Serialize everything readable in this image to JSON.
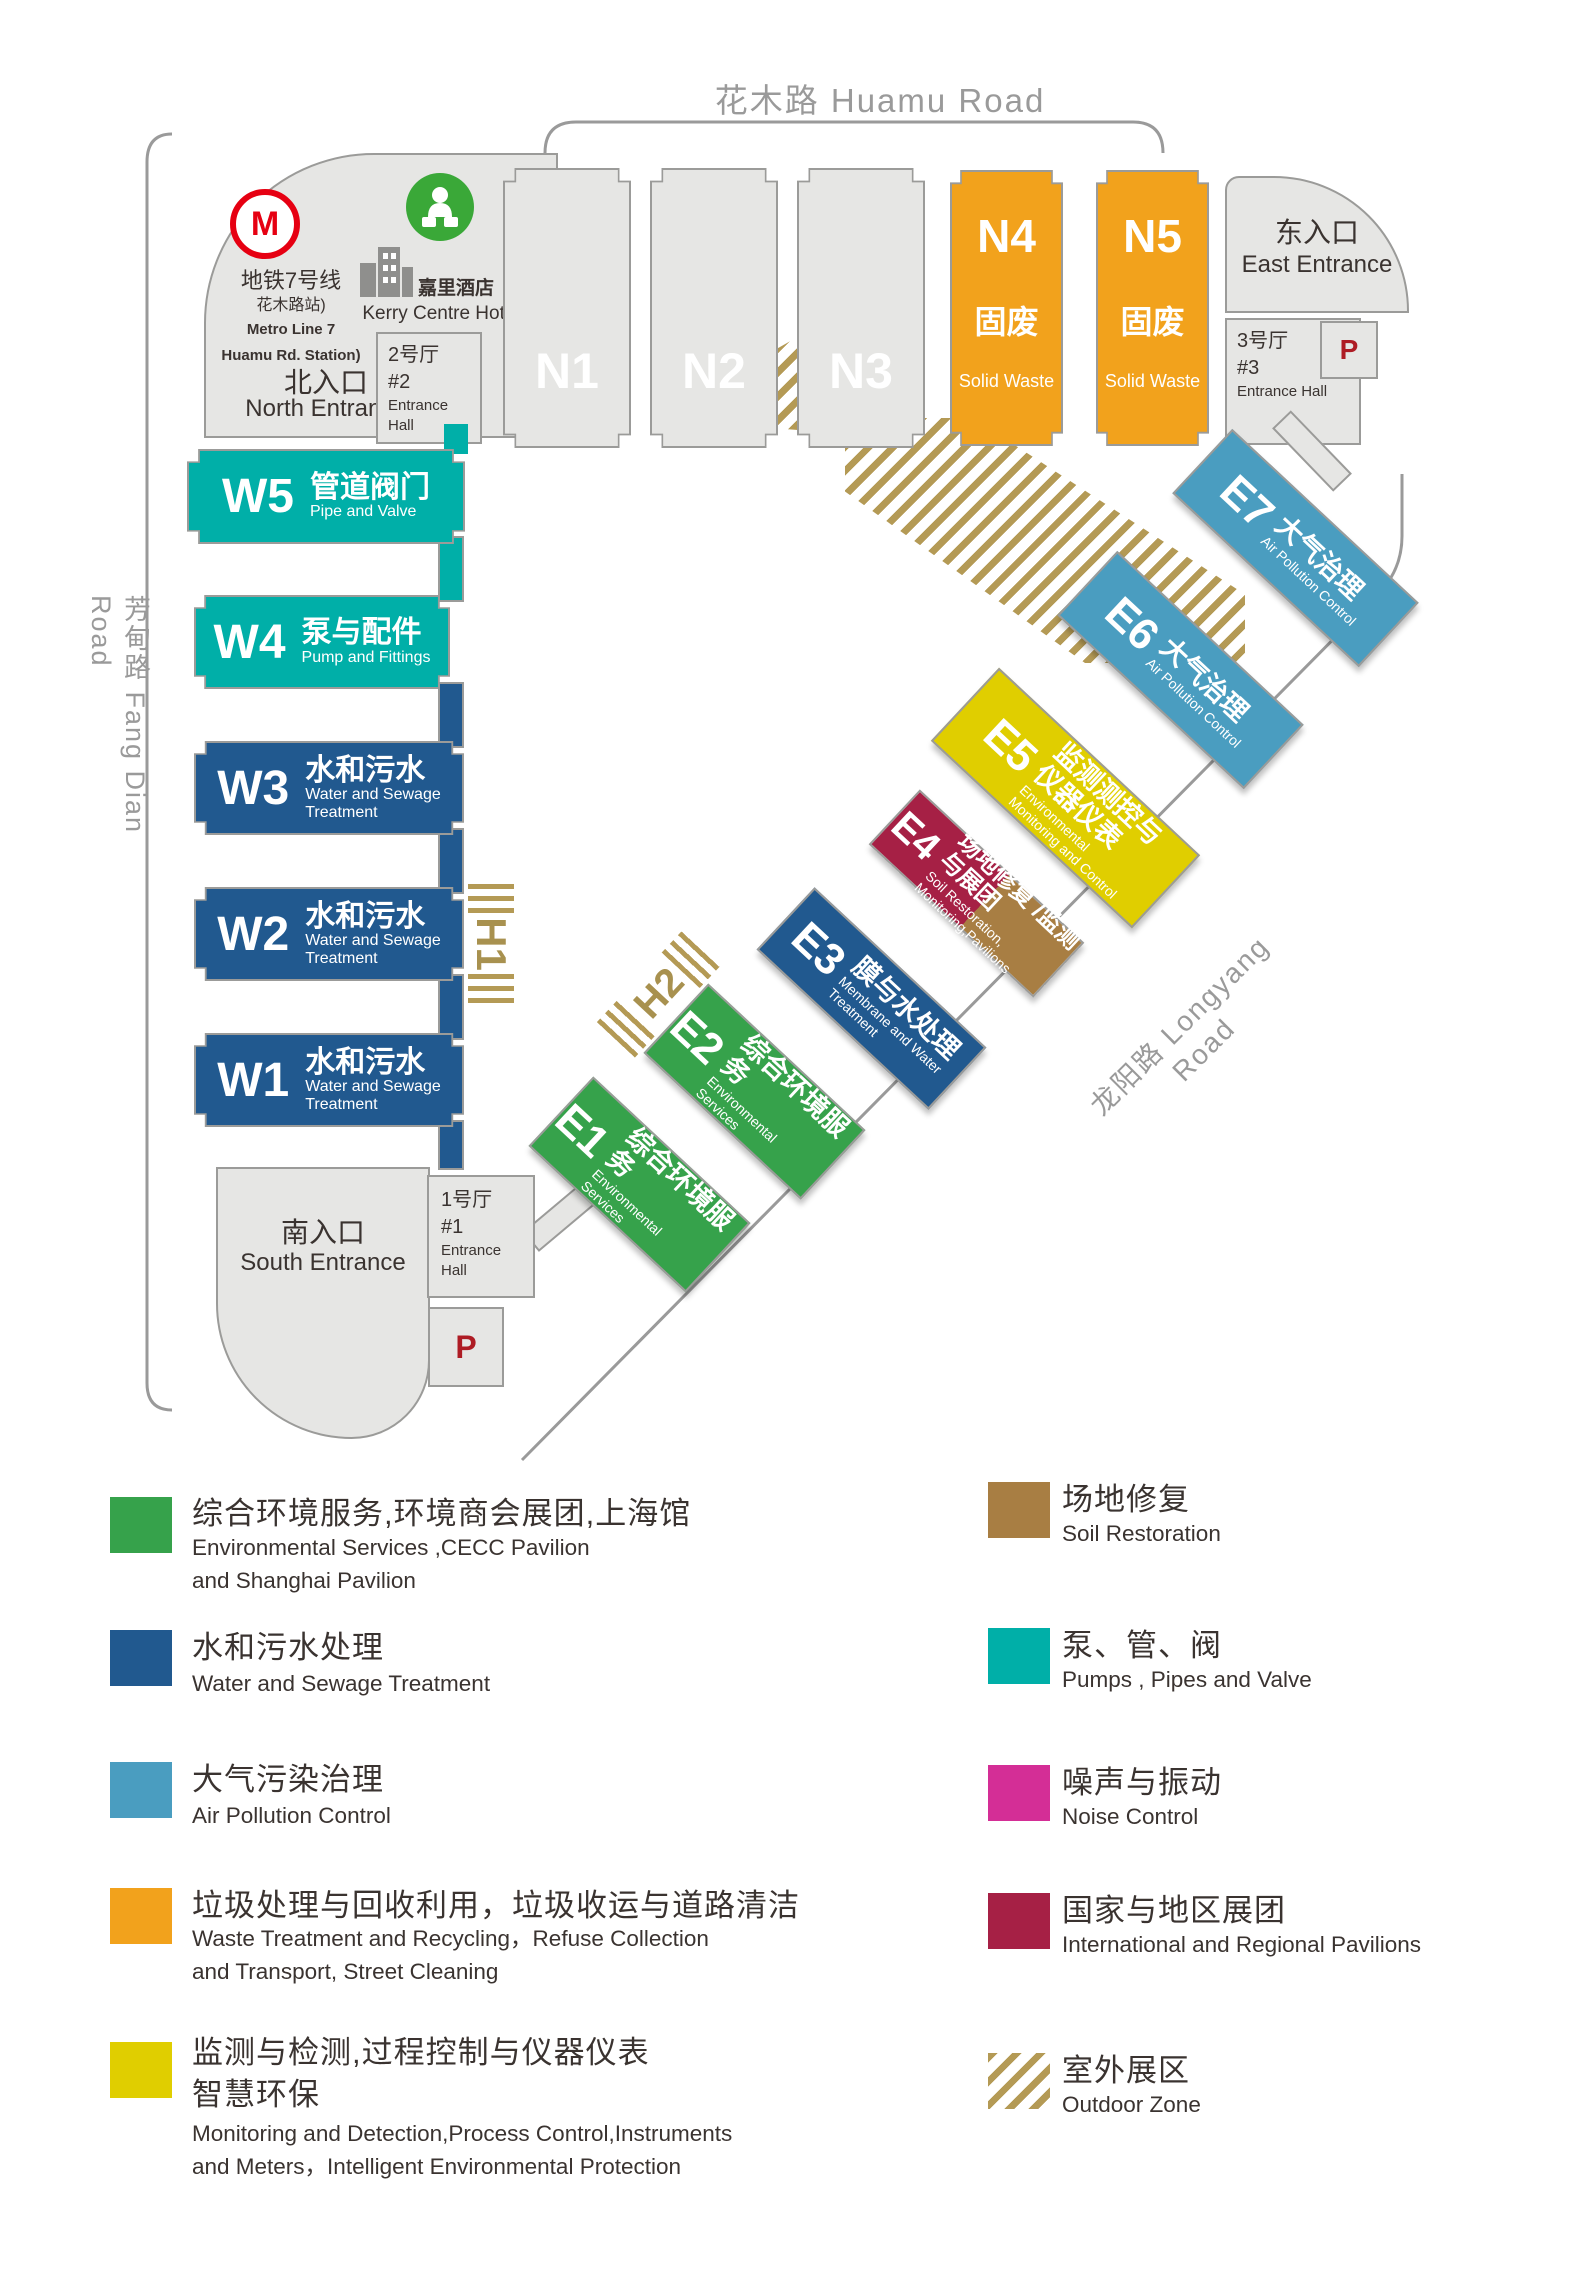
{
  "roads": {
    "huamu": "花木路 Huamu Road",
    "fangdian": "芳甸路  Fang Dian Road",
    "longyang": "龙阳路  Longyang Road"
  },
  "landmarks": {
    "metro_logo_letter": "M",
    "metro_line_zh": "地铁7号线",
    "metro_station_zh": "花木路站)",
    "metro_line_en": "Metro Line 7",
    "metro_station_en": "Huamu Rd. Station)",
    "hotel_zh": "嘉里酒店",
    "hotel_en": "Kerry Centre Hotel"
  },
  "entrances": {
    "north_zh": "北入口",
    "north_en": "North Entrance",
    "south_zh": "南入口",
    "south_en": "South Entrance",
    "east_zh": "东入口",
    "east_en": "East Entrance"
  },
  "entrance_halls": {
    "label_en": "Entrance Hall",
    "h1_zh": "1号厅",
    "h1_num": "#1",
    "h2_zh": "2号厅",
    "h2_num": "#2",
    "h3_zh": "3号厅",
    "h3_num": "#3"
  },
  "parking_label": "P",
  "outdoor_labels": {
    "h1": "H1",
    "h2": "H2",
    "h3": "H3"
  },
  "halls": {
    "n1": {
      "code": "N1"
    },
    "n2": {
      "code": "N2"
    },
    "n3": {
      "code": "N3"
    },
    "n4": {
      "code": "N4",
      "zh": "固废",
      "en": "Solid Waste"
    },
    "n5": {
      "code": "N5",
      "zh": "固废",
      "en": "Solid Waste"
    },
    "w5": {
      "code": "W5",
      "zh": "管道阀门",
      "en": "Pipe and Valve"
    },
    "w4": {
      "code": "W4",
      "zh": "泵与配件",
      "en": "Pump and Fittings"
    },
    "w3": {
      "code": "W3",
      "zh": "水和污水",
      "en": "Water and Sewage\nTreatment"
    },
    "w2": {
      "code": "W2",
      "zh": "水和污水",
      "en": "Water and Sewage\nTreatment"
    },
    "w1": {
      "code": "W1",
      "zh": "水和污水",
      "en": "Water and Sewage\nTreatment"
    },
    "e1": {
      "code": "E1",
      "zh": "综合环境服务",
      "en": "Environmental\nServices"
    },
    "e2": {
      "code": "E2",
      "zh": "综合环境服务",
      "en": "Environmental\nServices"
    },
    "e3": {
      "code": "E3",
      "zh": "膜与水处理",
      "en": "Membrane and Water\nTreatment"
    },
    "e4": {
      "code": "E4",
      "zh": "场地修复 /监测\n与展团",
      "en": "Soil Restoration,\nMonitoring,Pavilions"
    },
    "e5": {
      "code": "E5",
      "zh": "监测测控与\n仪器仪表",
      "en": "Environmental\nMonitoring and Control"
    },
    "e6": {
      "code": "E6",
      "zh": "大气治理",
      "en": "Air Pollution Control"
    },
    "e7": {
      "code": "E7",
      "zh": "大气治理",
      "en": "Air Pollution Control"
    }
  },
  "legend": {
    "left": [
      {
        "color": "#36a24b",
        "zh": "综合环境服务,环境商会展团,上海馆",
        "en": "Environmental Services ,CECC Pavilion\nand Shanghai Pavilion"
      },
      {
        "color": "#21598f",
        "zh": "水和污水处理",
        "en": "Water and Sewage Treatment"
      },
      {
        "color": "#4a9dc0",
        "zh": "大气污染治理",
        "en": "Air Pollution Control"
      },
      {
        "color": "#f2a21c",
        "zh": "垃圾处理与回收利用，垃圾收运与道路清洁",
        "en": "Waste Treatment and Recycling，Refuse Collection\n and Transport, Street Cleaning"
      },
      {
        "color": "#e0ce00",
        "zh": "监测与检测,过程控制与仪器仪表\n智慧环保",
        "en": "Monitoring and Detection,Process Control,Instruments\nand Meters，Intelligent Environmental Protection"
      }
    ],
    "right": [
      {
        "color": "#a87e43",
        "zh": "场地修复",
        "en": "Soil Restoration"
      },
      {
        "color": "#00afa8",
        "zh": "泵、管、阀",
        "en": "Pumps , Pipes and Valve"
      },
      {
        "color": "#d42e96",
        "zh": "噪声与振动",
        "en": "Noise Control"
      },
      {
        "color": "#a62045",
        "zh": "国家与地区展团",
        "en": "International and Regional Pavilions"
      },
      {
        "color": "hatch",
        "zh": "室外展区",
        "en": "Outdoor Zone"
      }
    ]
  },
  "colors": {
    "green": "#36a24b",
    "blue": "#21598f",
    "lightblue": "#4a9dc0",
    "orange": "#f2a21c",
    "yellow": "#e0ce00",
    "teal": "#00afa8",
    "brown": "#a87e43",
    "maroon": "#a62045",
    "magenta": "#d42e96",
    "gold": "#b49a55",
    "gray_block": "#e6e6e4",
    "border_gray": "#9b9b99",
    "road_gray": "#9a9a9a",
    "metro_red": "#e60012",
    "parking_red": "#ae1c24"
  }
}
